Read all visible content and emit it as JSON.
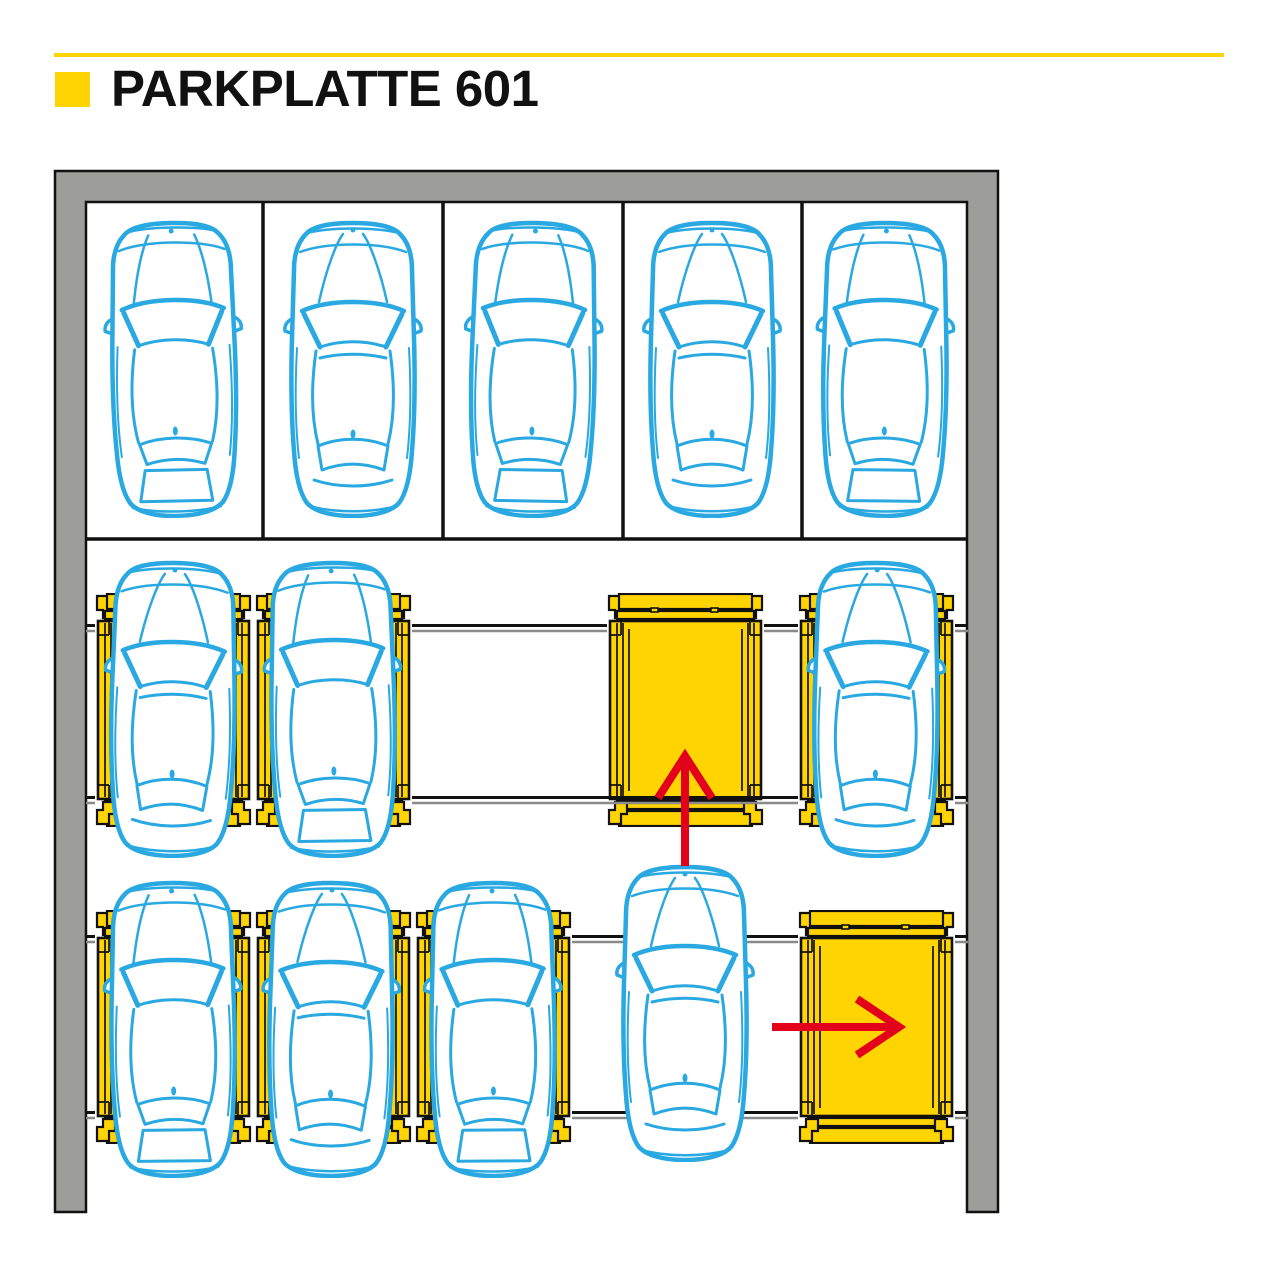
{
  "header": {
    "title": "PARKPLATTE 601"
  },
  "colors": {
    "accent_yellow": "#FFD400",
    "car_blue": "#29A8E1",
    "arrow_red": "#E2001A",
    "wall_gray": "#9D9D9C",
    "rail_gray": "#8A8A8A",
    "line_black": "#111111"
  },
  "diagram": {
    "wall": {
      "outer": {
        "x": 55,
        "y": 171,
        "w": 943,
        "h": 1041
      },
      "thickness": 31
    },
    "stalls": {
      "dividers_x": [
        263,
        443,
        623,
        802
      ],
      "top_y": 201,
      "bottom_y": 539,
      "left_x": 86,
      "right_x": 968
    },
    "rails": [
      {
        "y": 625.5,
        "segments": [
          [
            86,
            95
          ],
          [
            412,
            607
          ],
          [
            764,
            798
          ],
          [
            955,
            968
          ]
        ]
      },
      {
        "y": 797.5,
        "segments": [
          [
            86,
            95
          ],
          [
            412,
            607
          ],
          [
            764,
            798
          ],
          [
            955,
            968
          ]
        ],
        "over_platform_segment": [
          607,
          764
        ]
      },
      {
        "y": 936.5,
        "segments": [
          [
            86,
            95
          ],
          [
            572,
            798
          ],
          [
            955,
            968
          ]
        ]
      },
      {
        "y": 1112.5,
        "segments": [
          [
            86,
            95
          ],
          [
            572,
            798
          ],
          [
            955,
            968
          ]
        ]
      }
    ],
    "rows": [
      {
        "id": "rear-stall-row",
        "car_y": 218,
        "cars": [
          {
            "cx": 174,
            "variant": "a",
            "tilt": -1.2
          },
          {
            "cx": 353,
            "variant": "b",
            "tilt": 0
          },
          {
            "cx": 533,
            "variant": "a",
            "tilt": 1
          },
          {
            "cx": 712,
            "variant": "b",
            "tilt": 0
          },
          {
            "cx": 885,
            "variant": "a",
            "tilt": 0.6
          }
        ]
      },
      {
        "id": "middle-platform-row",
        "platform_y": 593,
        "car_y": 558,
        "platforms": [
          {
            "x": 95,
            "state": "occupied"
          },
          {
            "x": 255,
            "state": "occupied"
          },
          {
            "x": 607,
            "state": "empty-target"
          },
          {
            "x": 798,
            "state": "occupied"
          }
        ],
        "cars": [
          {
            "cx": 173,
            "variant": "b",
            "tilt": 0.8
          },
          {
            "cx": 333,
            "variant": "a",
            "tilt": -0.8
          },
          {
            "cx": 876,
            "variant": "b",
            "tilt": 0.5
          }
        ]
      },
      {
        "id": "front-platform-row",
        "platform_y": 910,
        "car_y": 878,
        "platforms": [
          {
            "x": 95,
            "state": "occupied"
          },
          {
            "x": 255,
            "state": "occupied"
          },
          {
            "x": 415,
            "state": "occupied"
          },
          {
            "x": 798,
            "state": "empty-target"
          }
        ],
        "cars": [
          {
            "cx": 173,
            "variant": "a",
            "tilt": -0.6
          },
          {
            "cx": 331,
            "variant": "b",
            "tilt": 0.4
          },
          {
            "cx": 493,
            "variant": "a",
            "tilt": -0.4
          },
          {
            "cx": 685,
            "variant": "b",
            "tilt": 0,
            "car_y": 862,
            "moving": true
          }
        ]
      }
    ],
    "arrows": [
      {
        "id": "shift-up",
        "type": "up",
        "x": 685,
        "from_y": 866,
        "to_y": 756
      },
      {
        "id": "shift-right",
        "type": "right",
        "y": 1027,
        "from_x": 772,
        "to_x": 899
      }
    ]
  }
}
